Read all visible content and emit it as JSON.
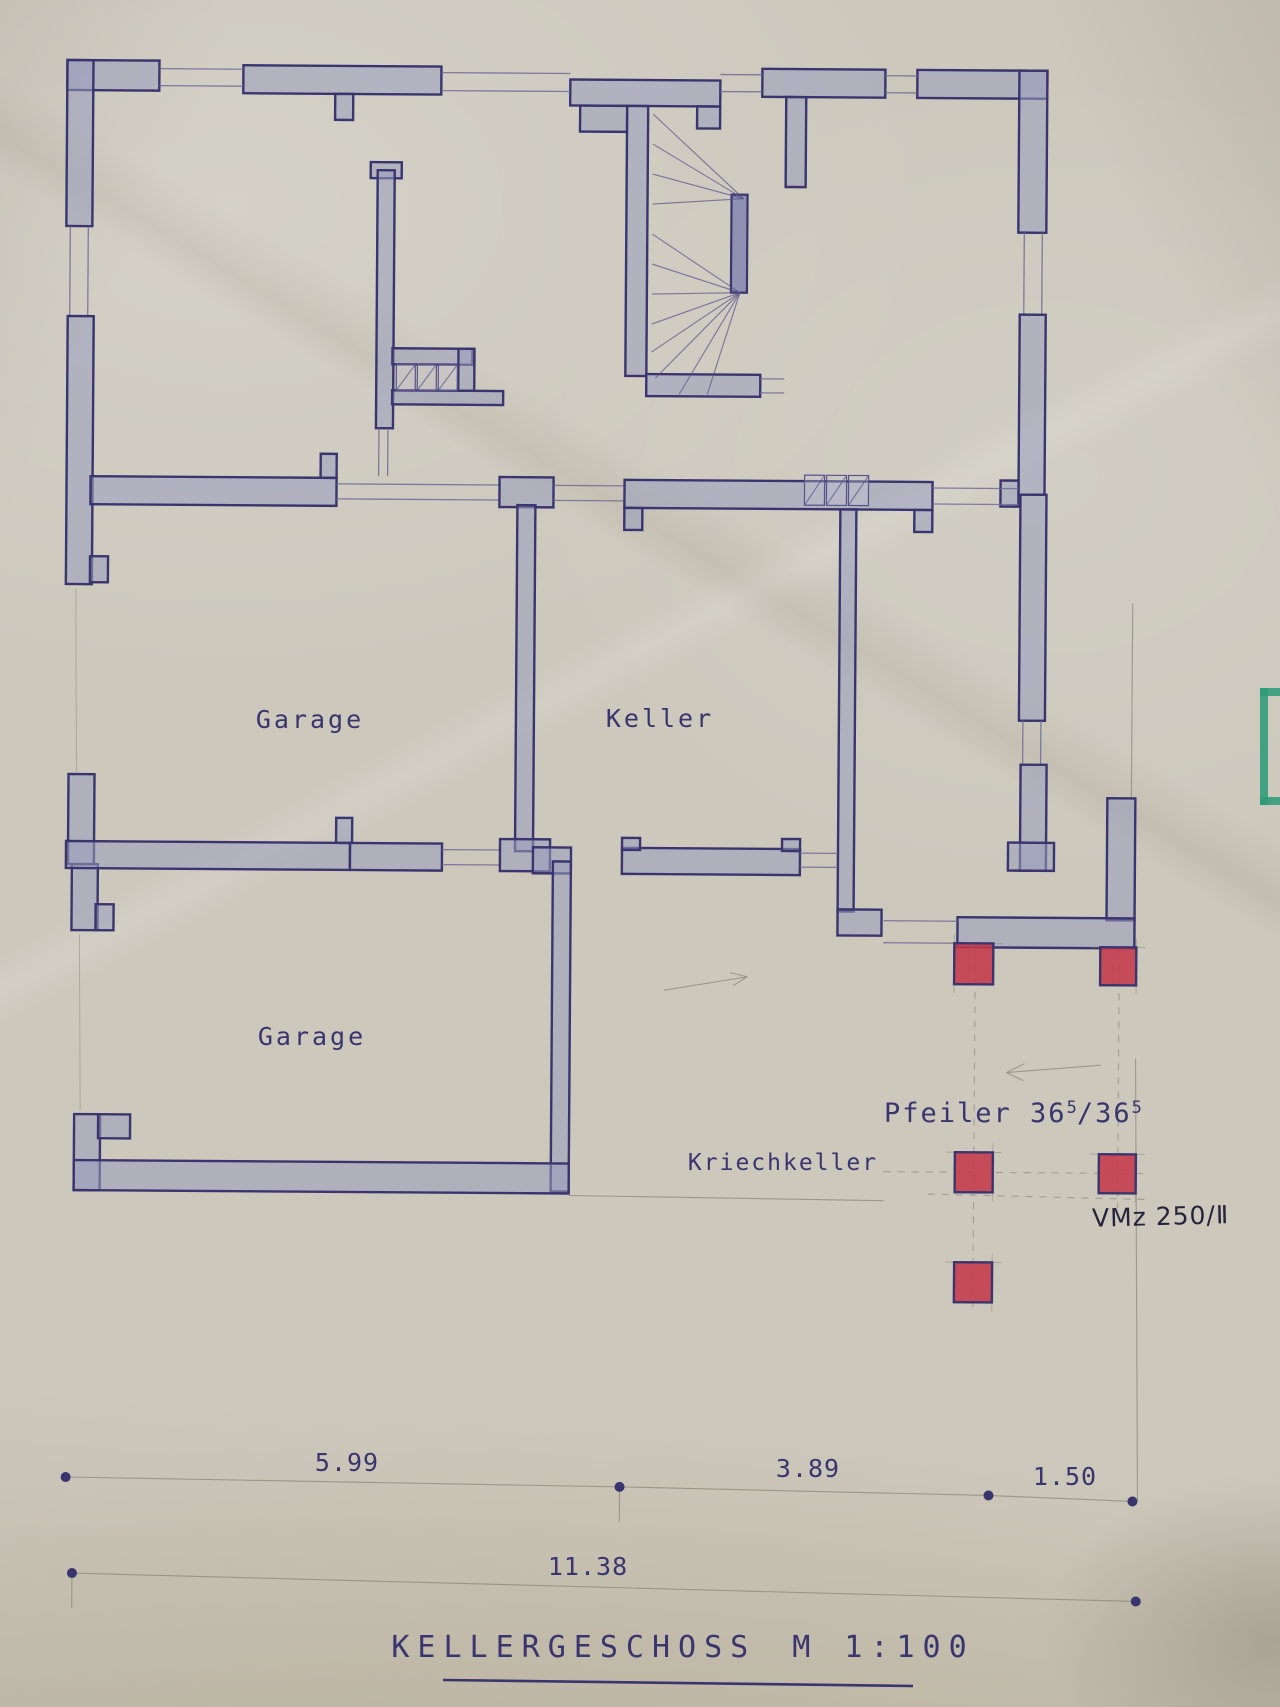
{
  "titleblock": {
    "title": "KELLERGESCHOSS",
    "scale": "M 1:100"
  },
  "rooms": {
    "garage_upper": "Garage",
    "keller": "Keller",
    "garage_lower": "Garage",
    "kriechkeller": "Kriechkeller"
  },
  "annotations": {
    "pfeiler": {
      "prefix": "Pfeiler 36",
      "sup1": "5",
      "mid": "/36",
      "sup2": "5"
    },
    "vmz": "VMz 250/Ⅱ"
  },
  "dimensions": {
    "row1": [
      "5.99",
      "3.89",
      "1.50"
    ],
    "total": "11.38"
  },
  "colors": {
    "paper": "#ccc8bc",
    "ink": "#3a356e",
    "wall_fill": "#999dbd",
    "pillar_red": "#c5394a",
    "pencil": "#8b8779",
    "pen_black": "#25243c",
    "green_edge": "#2f9b77"
  }
}
